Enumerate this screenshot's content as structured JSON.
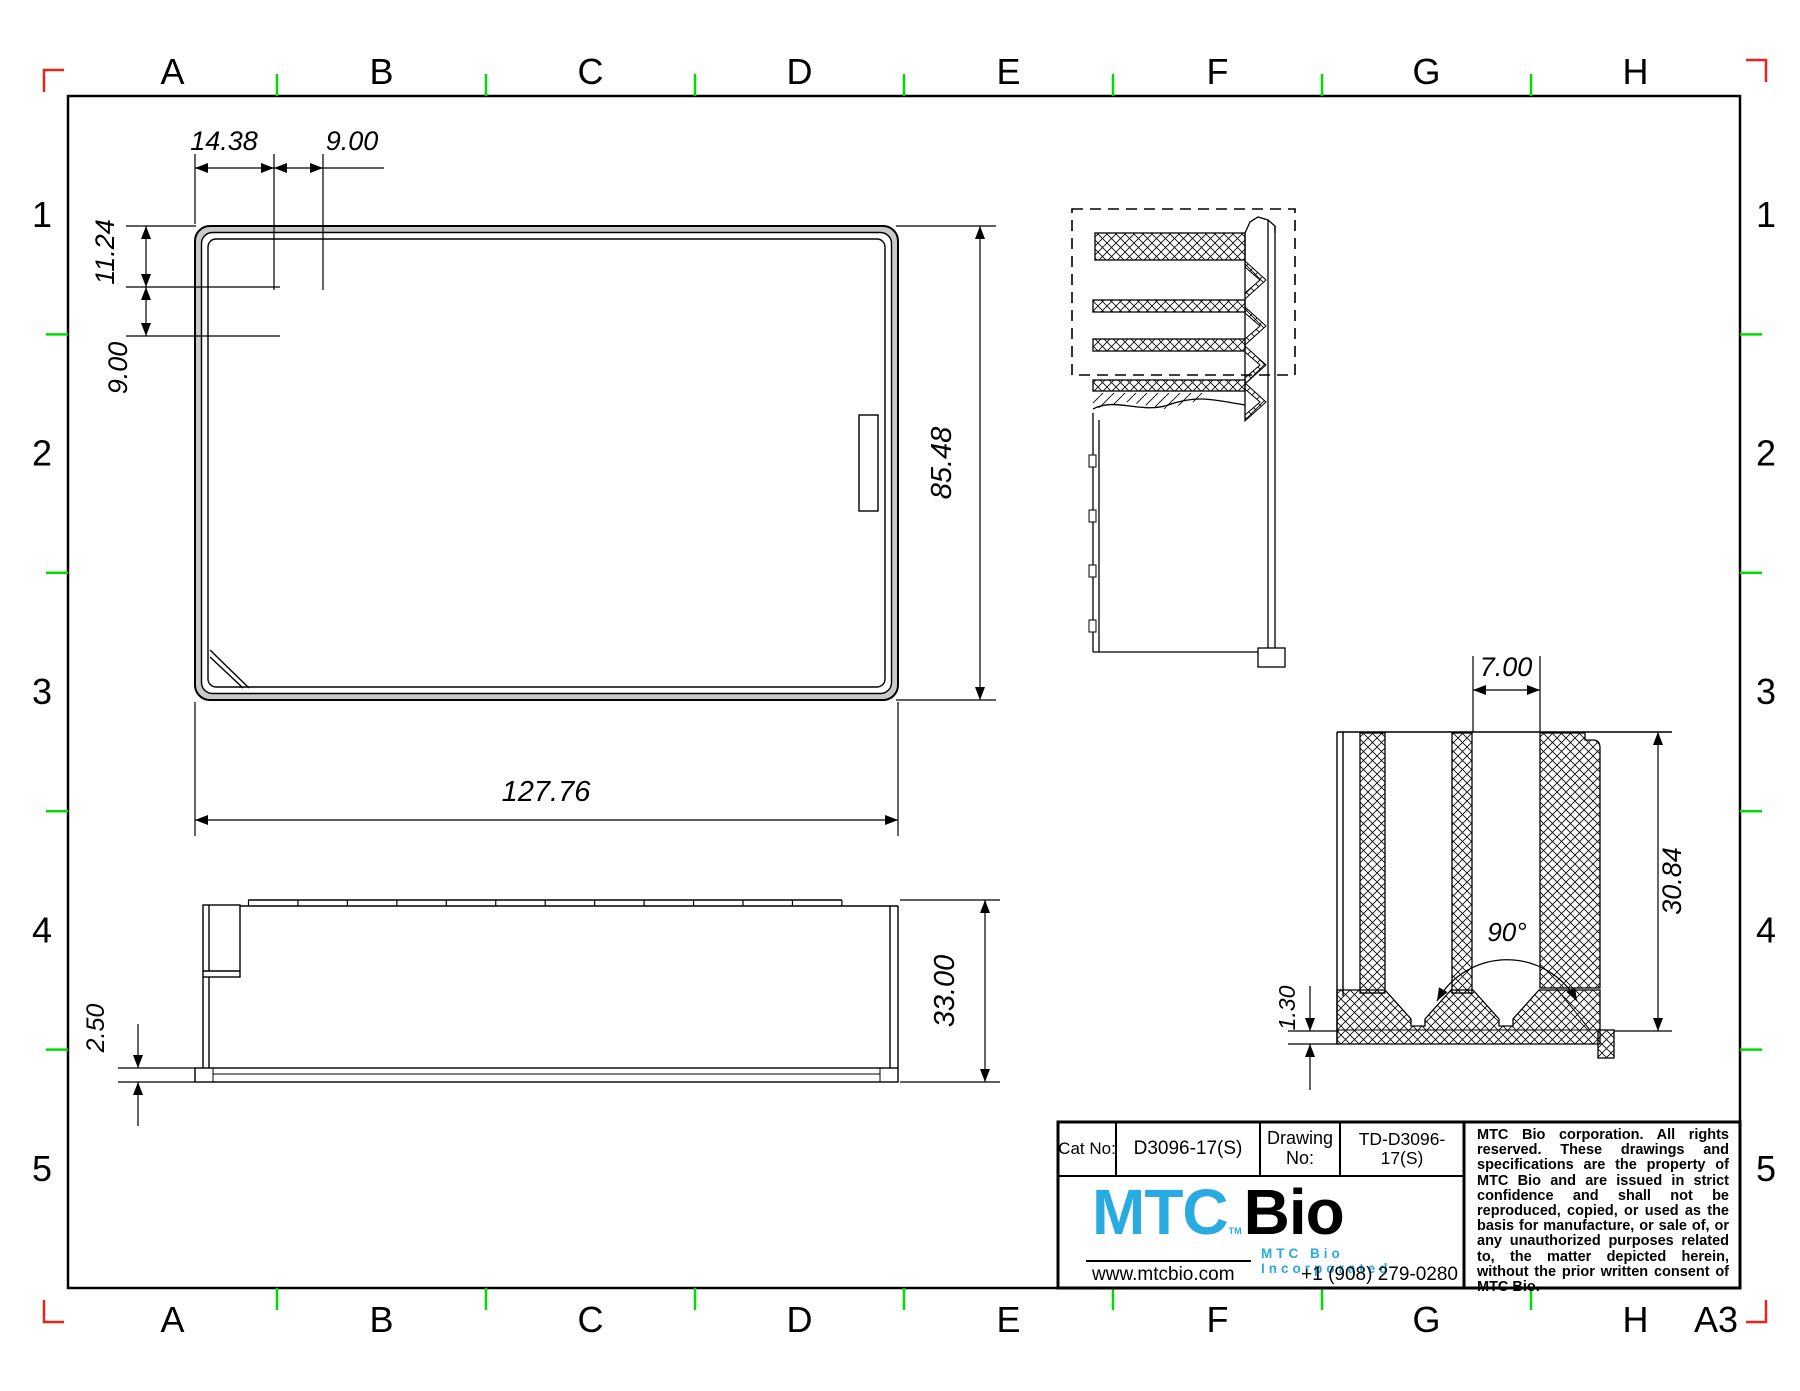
{
  "sheet": {
    "paper_label": "A3",
    "columns": [
      "A",
      "B",
      "C",
      "D",
      "E",
      "F",
      "G",
      "H"
    ],
    "rows": [
      "1",
      "2",
      "3",
      "4",
      "5"
    ],
    "colors": {
      "tick_green": "#00dc00",
      "corner_red": "#e8241c",
      "logo_cyan": "#29aae1",
      "line_black": "#000000",
      "rim_gray": "#c9c9c9"
    }
  },
  "plate_top_view": {
    "column_labels": [
      "1",
      "2",
      "3",
      "4",
      "5",
      "6",
      "7",
      "8",
      "9",
      "10",
      "11",
      "12"
    ],
    "row_labels": [
      "A",
      "B",
      "C",
      "D",
      "E",
      "F",
      "G",
      "H"
    ],
    "dims": {
      "offset_x": "14.38",
      "pitch_x": "9.00",
      "offset_y": "11.24",
      "pitch_y": "9.00",
      "length": "127.76",
      "width": "85.48"
    }
  },
  "plate_side_view": {
    "dims": {
      "skirt": "2.50",
      "height": "33.00"
    }
  },
  "well_detail_view": {
    "dims": {
      "diameter": "7.00",
      "depth": "30.84",
      "angle": "90°",
      "floor": "1.30"
    }
  },
  "title_block": {
    "cat_no_label": "Cat No:",
    "cat_no_value": "D3096-17(S)",
    "drawing_no_label_1": "Drawing",
    "drawing_no_label_2": "No:",
    "drawing_no_value": "TD-D3096-17(S)",
    "logo": {
      "mtc": "MTC",
      "tm": "TM",
      "bio": "Bio",
      "tagline": "MTC Bio Incorporated"
    },
    "website": "www.mtcbio.com",
    "phone": "+1 (908) 279-0280",
    "legal": "MTC Bio corporation. All rights reserved. These drawings and specifications are the property of MTC Bio and are issued in strict confidence and shall not be reproduced, copied, or used as the basis for manufacture, or sale of, or any unauthorized purposes related to, the matter depicted herein, without the prior written consent of MTC Bio."
  }
}
